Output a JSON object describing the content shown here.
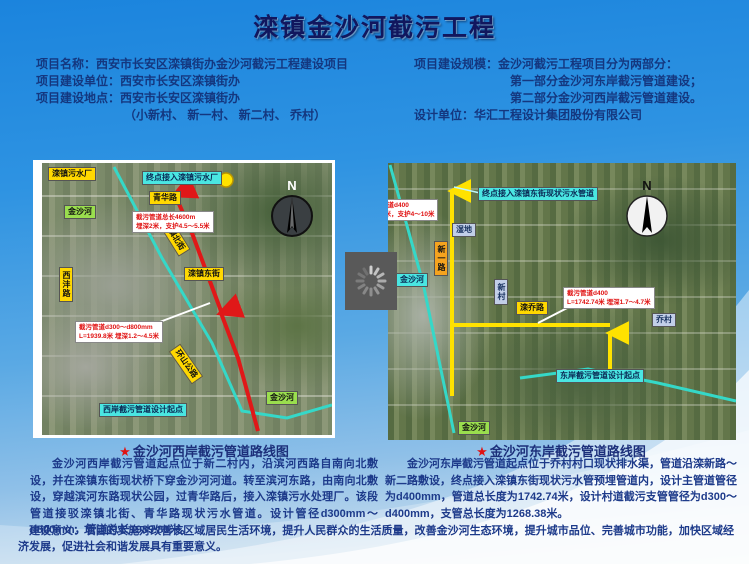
{
  "slide": {
    "title": "滦镇金沙河截污工程",
    "info_left": [
      "项目名称：西安市长安区滦镇街办金沙河截污工程建设项目",
      "项目建设单位：西安市长安区滦镇街办",
      "项目建设地点：西安市长安区滦镇街办",
      "（小新村、 新一村、 新二村、 乔村）"
    ],
    "info_right": [
      "项目建设规模：金沙河截污工程项目分为两部分：",
      "第一部分金沙河东岸截污管道建设；",
      "第二部分金沙河西岸截污管道建设。",
      "设计单位：华汇工程设计集团股份有限公司"
    ],
    "map_west": {
      "compass_n": "N",
      "labels": {
        "plant": "滦镇污水厂",
        "endpoint": "终点接入滦镇污水厂",
        "qinghua_road": "青华路",
        "river_upper": "金沙河",
        "note_upper_line1": "截污管道总长4600m",
        "note_upper_line2": "埋深2米，支护4.5～5.5米",
        "luanzhen_north_st": "滦镇北街",
        "luanzhen_east_st": "滦镇东街",
        "xifeng_road": "西沣路",
        "note_lower_line1": "截污管道d300～d800mm",
        "note_lower_line2": "L=1939.8米 埋深1.2～4.5米",
        "huanshan_road": "环山公路",
        "river_lower": "金沙河",
        "start_point": "西岸截污管道设计起点"
      }
    },
    "map_east": {
      "compass_n": "N",
      "labels": {
        "endpoint": "终点接入滦镇东街现状污水管道",
        "note_upper_line1": "截污管道d400",
        "note_upper_line2": "埋深2米，支护4～10米",
        "wetland": "湿地",
        "xinyi_road": "新一路",
        "xincun": "新村",
        "river_left": "金沙河",
        "luanqiao_road": "滦乔路",
        "note_lower_line1": "截污管道d400",
        "note_lower_line2": "L=1742.74米 埋深1.7～4.7米",
        "qiaocun": "乔村",
        "start_point": "东岸截污管道设计起点",
        "river_bottom": "金沙河"
      }
    },
    "captions": {
      "west": {
        "star": "★",
        "title": "金沙河西岸截污管道路线图",
        "body": "金沙河西岸截污管道起点位于新二村内，沿滨河西路自南向北敷设，并在滦镇东街现状桥下穿金沙河河道。转至滨河东路，由南向北敷设，穿越滨河东路现状公园，过青华路后，接入滦镇污水处理厂。该段管道接驳滦镇北街、青华路现状污水管道。设计管径d300mm～d800mm，管道总长1939.80米。"
      },
      "east": {
        "star": "★",
        "title": "金沙河东岸截污管道路线图",
        "body": "金沙河东岸截污管道起点位于乔村村口现状排水渠，管道沿滦新路～新二路敷设，终点接入滦镇东街现状污水管预埋管道内，设计主管道管径为d400mm，管道总长度为1742.74米，设计村道截污支管管径为d300～d400mm，支管总长度为1268.38米。"
      }
    },
    "footer": "建设意义：项目的实施对改善该区域居民生活环境，提升人民群众的生活质量，改善金沙河生态环境，提升城市品位、完善城市功能，加快区域经济发展，促进社会和谐发展具有重要意义。",
    "colors": {
      "route_red": "#e01818",
      "route_yellow": "#ffe200",
      "river_cyan": "#35d8c8",
      "label_yellow": "#ffd800",
      "label_cyan": "#4ae6e2",
      "label_green": "#9ade4e",
      "text_blue": "#1d3a8a"
    }
  }
}
